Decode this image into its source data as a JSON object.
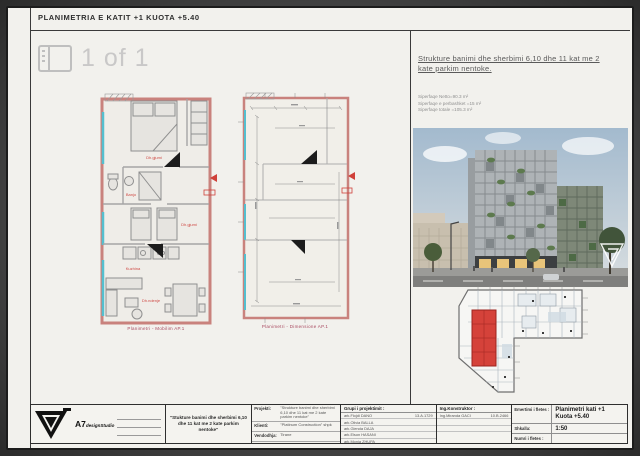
{
  "header": {
    "title": "PLANIMETRIA E KATIT +1  KUOTA +5.40"
  },
  "viewer": {
    "page_indicator": "1 of 1"
  },
  "colors": {
    "wall_red": "#c9827d",
    "accent_red": "#d0413a",
    "glazing_cyan": "#54bfcf"
  },
  "plans": {
    "plan_a": {
      "caption": "Planimetri - Mobilim AP.1",
      "labels": [
        "Dh.gjumi",
        "Banjo",
        "Dh.gjumi",
        "Kuzhina",
        "Dh.ndenje"
      ]
    },
    "plan_b": {
      "caption": "Planimetri - Dimensione AP.1"
    }
  },
  "info": {
    "heading_line1": "Strukture  banimi dhe sherbimi 6,10 dhe 11 kat  me 2",
    "heading_line2": "kate parkim nentoke.",
    "areas": [
      "Siperfaqe Netto=90.3 m²",
      "Siperfaqe e perbashket =15 m²",
      "Siperfaqe totale =105.3 m²"
    ]
  },
  "titleblock": {
    "company": {
      "short": "A7",
      "suffix": "designStudio"
    },
    "project_quote": "\"Stukture banimi dhe sherbimi 6,10 dhe 11 kat me 2 kate parkim nentoke\"",
    "fields": [
      {
        "label": "Projekti:",
        "value": "\"Strukture banimi dhe sherbimi 6,10 dhe 11 kat me 2 kate parkim nentoke\""
      },
      {
        "label": "Klienti:",
        "value": "\"Platinum Construction\" shpk"
      },
      {
        "label": "Vendodhja:",
        "value": "Tirane"
      },
      {
        "label": "Viti:",
        "value": "2021"
      }
    ],
    "team": {
      "label": "Grupi i projektimit :",
      "members": [
        {
          "name": "ark.Flojdi DANO",
          "license": "13.A.1729"
        },
        {
          "name": "ark.Olivia BALLA",
          "license": ""
        },
        {
          "name": "ark.Glenda DAJA",
          "license": ""
        },
        {
          "name": "ark.Elson HASANI",
          "license": ""
        },
        {
          "name": "ark.Monia ZHUPA",
          "license": ""
        }
      ]
    },
    "engineer": {
      "label": "Ing.Konstruktor :",
      "name": "Ing.Miranda GACI",
      "license": "10.B.2466"
    },
    "sheet": {
      "name_label": "Emertimi i fletes :",
      "name_value_line1": "Planimetri kati +1",
      "name_value_line2": "Kuota +5.40",
      "scale_label": "Shkalla:",
      "scale_value": "1:50",
      "number_label": "Numri i fletes :",
      "number_value": ""
    }
  }
}
